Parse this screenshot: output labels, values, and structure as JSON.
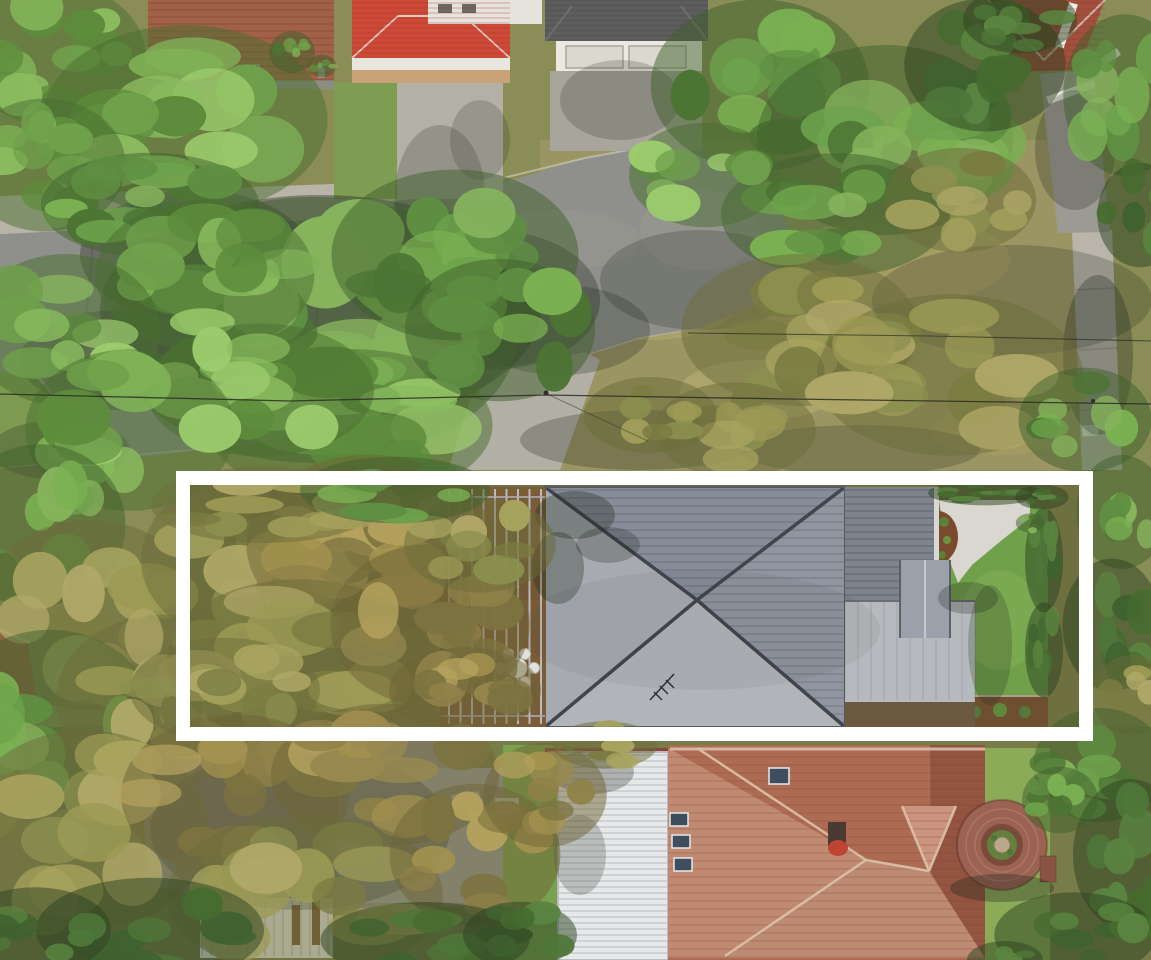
{
  "meta": {
    "image_type": "aerial-drone-photograph",
    "subject": "top-down aerial view of a suburban residential block with one property highlighted by a white rectangular boundary overlay",
    "visible_text": "none"
  },
  "highlight_box": {
    "purpose": "property-boundary-highlight",
    "outer_x": 176,
    "outer_y": 471,
    "outer_width": 917,
    "outer_height": 270,
    "stroke_color": "#ffffff",
    "stroke_width": 14
  },
  "scene": {
    "objects": [
      {
        "name": "street-road",
        "description": "asphalt road running across upper-left, shaded by large street trees"
      },
      {
        "name": "footpath-top-left",
        "description": "concrete footpath along upper-left verge"
      },
      {
        "name": "footpath-right",
        "description": "concrete footpath running vertically on right verge"
      },
      {
        "name": "brick-courtyard",
        "description": "red brick paved courtyard, top-left property"
      },
      {
        "name": "red-roof-house-top",
        "description": "bright red hipped tile roof house with concrete driveway, top edge"
      },
      {
        "name": "garage-house-top",
        "description": "white house with dark grey shingle roof and double garage, top centre"
      },
      {
        "name": "brick-roof-house-top-right",
        "description": "dark red brick-tile hip roof with white fence and grey path, top-right corner"
      },
      {
        "name": "highlighted-property",
        "description": "long block outlined in white: tree-filled rear yard, timber deck with pergola and round outdoor dining table with six chairs, large grey hipped-roof house, grey skillion garage roof, white concrete driveway, green lawn and hedge"
      },
      {
        "name": "bottom-house",
        "description": "weathered terracotta hip roof with four skylights and chimney plus white corrugated metal roof extension"
      },
      {
        "name": "circular-brick-garden",
        "description": "round brick paved feature with central planted ring, bottom-right lawn"
      },
      {
        "name": "blue-pool-or-trampoline",
        "description": "small blue object under trees, left verge"
      },
      {
        "name": "power-lines",
        "description": "two thin overhead cables crossing the street and verge"
      }
    ],
    "deck_furniture": {
      "table_count": 1,
      "chair_count": 6,
      "table_color": "#e9e9e6"
    }
  },
  "colors": {
    "road": "#8f908b",
    "road_shadow": "#55584f",
    "footpath": "#b8b4a8",
    "concrete_driveway": "#b2afa5",
    "driveway_white": "#d9d7cf",
    "lawn_bright": "#70a04a",
    "lawn_bottom": "#8cab58",
    "verge_dry": "#9a9563",
    "deck_wood": "#7b5c39",
    "pergola_beam": "#c6cbd1",
    "roof_main_light": "#a7abb1",
    "roof_main_south": "#b1b4b8",
    "roof_main_dark": "#868d99",
    "roof_main_east": "#9095a0",
    "roof_ridge": "#41454d",
    "roof_wing": "#7e838e",
    "roof_skillion": "#b6b9bd",
    "roof_red_bright": "#cd4a39",
    "roof_red_weathered": "#ad6b54",
    "roof_red_sunlit": "#c08a72",
    "roof_red_shaded": "#935441",
    "roof_white_metal": "#e7e8e9",
    "roof_dark_shingle": "#595959",
    "roof_gray_hidden": "#9b9ea0",
    "brick_paving": "#a06148",
    "brick_circle": "#9c6353",
    "garden_bed": "#7a4a2e",
    "hedge_dark": "#44602e",
    "pool_blue": "#3f6f9e",
    "white_wall": "#ebe9e2",
    "frame_white": "#ffffff",
    "palettes": {
      "bright": [
        "#4a6e30",
        "#6fa04b",
        "#7fb257",
        "#8abc5f",
        "#5d8c3c",
        "#9ccb6d"
      ],
      "mid": [
        "#3f5f2c",
        "#5f8f42",
        "#6da34c",
        "#7ab052",
        "#86b35c",
        "#4c7434"
      ],
      "dark": [
        "#2c4220",
        "#3f6230",
        "#4e7639",
        "#5a8440",
        "#466b2f"
      ],
      "olive": [
        "#6b6c3a",
        "#8a8f4e",
        "#9c9a55",
        "#a8a45f",
        "#b0a868",
        "#7a7c42"
      ],
      "brown": [
        "#6e6336",
        "#8f8148",
        "#a3914f",
        "#b5a25e",
        "#7c7340",
        "#97894f"
      ]
    }
  }
}
